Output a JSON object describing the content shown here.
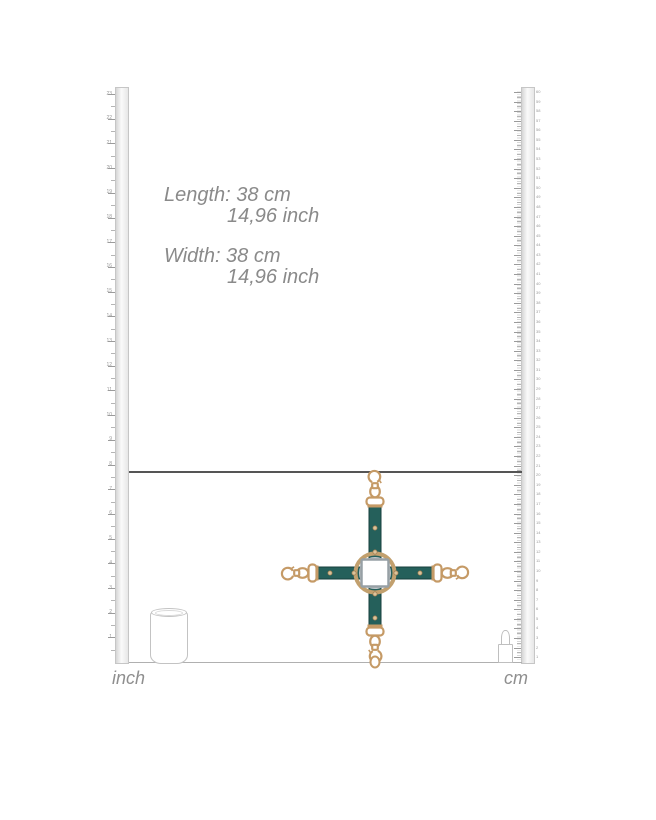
{
  "dimensions": {
    "length_line1": "Length: 38 cm",
    "length_line2": "14,96 inch",
    "width_line1": "Width: 38 cm",
    "width_line2": "14,96 inch"
  },
  "rulers": {
    "inch": {
      "unit": "inch",
      "labels": [
        23,
        22,
        21,
        20,
        19,
        18,
        17,
        16,
        15,
        14,
        13,
        12,
        11,
        10,
        9,
        8,
        7,
        6,
        5,
        4,
        3,
        2,
        1
      ]
    },
    "cm": {
      "unit": "cm",
      "labels": [
        60,
        59,
        58,
        57,
        56,
        55,
        54,
        53,
        52,
        51,
        50,
        49,
        48,
        47,
        46,
        45,
        44,
        43,
        42,
        41,
        40,
        39,
        38,
        37,
        36,
        35,
        34,
        33,
        32,
        31,
        30,
        29,
        28,
        27,
        26,
        25,
        24,
        23,
        22,
        21,
        20,
        19,
        18,
        17,
        16,
        15,
        14,
        13,
        12,
        11,
        10,
        9,
        8,
        7,
        6,
        5,
        4,
        3,
        2,
        1
      ]
    }
  },
  "scale_references": {
    "left_object": "soda-can",
    "right_object": "lipstick"
  },
  "product": {
    "name": "hogtie-cross-with-snap-hooks",
    "strap_color": "#25605b",
    "strap_edge_color": "#173f3c",
    "hardware_color": "#c59a66",
    "rivet_color": "#dcc39a",
    "ring_color": "#c2a06e",
    "center_square_color": "#ffffff",
    "center_square_edge": "#97a0a5"
  },
  "colors": {
    "background": "#ffffff",
    "spec_text": "#8a8a8a",
    "ruler_number": "#9a9a9a",
    "horizon_line": "#555555",
    "floor_line": "#b0b0b0"
  }
}
